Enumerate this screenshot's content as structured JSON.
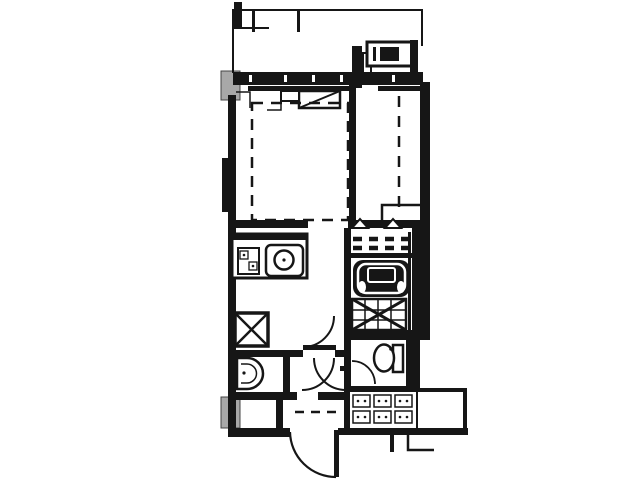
{
  "page": {
    "type": "architectural-floor-plan",
    "description": "Black and white floor plan of a one-room apartment unit: balcony with railing and outdoor unit at top, sliding window band, main room with dashed bed outline and air-conditioner symbol, narrow side room with dashed line, kitchen counter with gas stove and sink, pipe shaft marked with X, unit bathroom with folding door, bathtub and tiled floor, washroom with basin, toilet room, entrance hall with shoe cabinet, outward-swinging entrance door and exterior corridor"
  },
  "palette": {
    "line": "#161616",
    "background": "#ffffff",
    "concrete_gray": "#a8a8a8"
  },
  "plan": {
    "rooms": [
      {
        "name": "balcony"
      },
      {
        "name": "main-room"
      },
      {
        "name": "side-room"
      },
      {
        "name": "kitchen"
      },
      {
        "name": "bathroom"
      },
      {
        "name": "washroom"
      },
      {
        "name": "toilet-room"
      },
      {
        "name": "entrance-hall"
      },
      {
        "name": "outside-corridor"
      }
    ],
    "fixtures": [
      "balcony-railing",
      "outdoor-unit",
      "sliding-window",
      "concrete-column",
      "air-conditioner-symbol",
      "bed-dashed-outline",
      "kitchen-counter",
      "gas-stove",
      "kitchen-sink",
      "pipe-shaft-x",
      "folding-door-dashes",
      "bathtub",
      "tiled-floor-hatch",
      "washbasin",
      "toilet",
      "interior-door-swing",
      "crossing-door-swings",
      "entrance-door-swing",
      "shoe-cabinet",
      "entry-step-dash"
    ]
  }
}
